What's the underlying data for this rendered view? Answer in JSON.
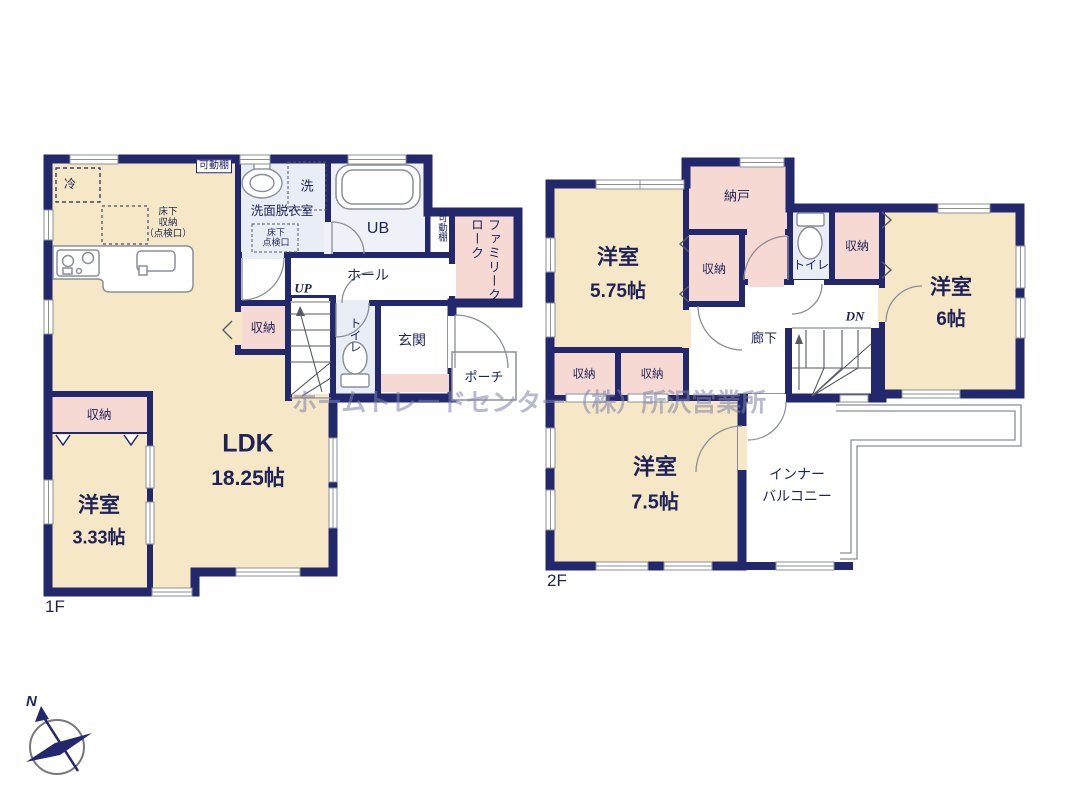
{
  "watermark": "ホームトレードセンター（株）所沢営業所",
  "compass": {
    "north": "N"
  },
  "floor1": {
    "label": "1F",
    "ldk": {
      "name": "LDK",
      "size": "18.25帖"
    },
    "yoshitsu": {
      "name": "洋室",
      "size": "3.33帖"
    },
    "yoshitsu_closet": "収納",
    "closet_mid": "収納",
    "hall": "ホール",
    "up": "UP",
    "toilet": "トイレ",
    "genkan": "玄関",
    "porch": "ポーチ",
    "ub": "UB",
    "senmen": "洗面脱衣室",
    "laundry": "洗",
    "fridge": "冷",
    "shelf_top": "可動棚",
    "shelf_side": "可動棚",
    "family_cloak": "ファミリークローク",
    "underfloor_l1": "床下",
    "underfloor_l2": "収納",
    "underfloor_l3": "（点検口）",
    "inspection_l1": "床下",
    "inspection_l2": "点検口"
  },
  "floor2": {
    "label": "2F",
    "yoshitsu575": {
      "name": "洋室",
      "size": "5.75帖"
    },
    "yoshitsu6": {
      "name": "洋室",
      "size": "6帖"
    },
    "yoshitsu75": {
      "name": "洋室",
      "size": "7.5帖"
    },
    "nando": "納戸",
    "closet_small": "収納",
    "closet_right": "収納",
    "closet_c": "収納",
    "closet_d": "収納",
    "toilet": "トイレ",
    "hallway": "廊下",
    "dn": "DN",
    "balcony_l1": "インナー",
    "balcony_l2": "バルコニー"
  },
  "colors": {
    "wall": "#23276b",
    "room": "#f6e8c6",
    "closet": "#f7d9d4",
    "wet": "#e9eef6",
    "text": "#1e2257"
  }
}
